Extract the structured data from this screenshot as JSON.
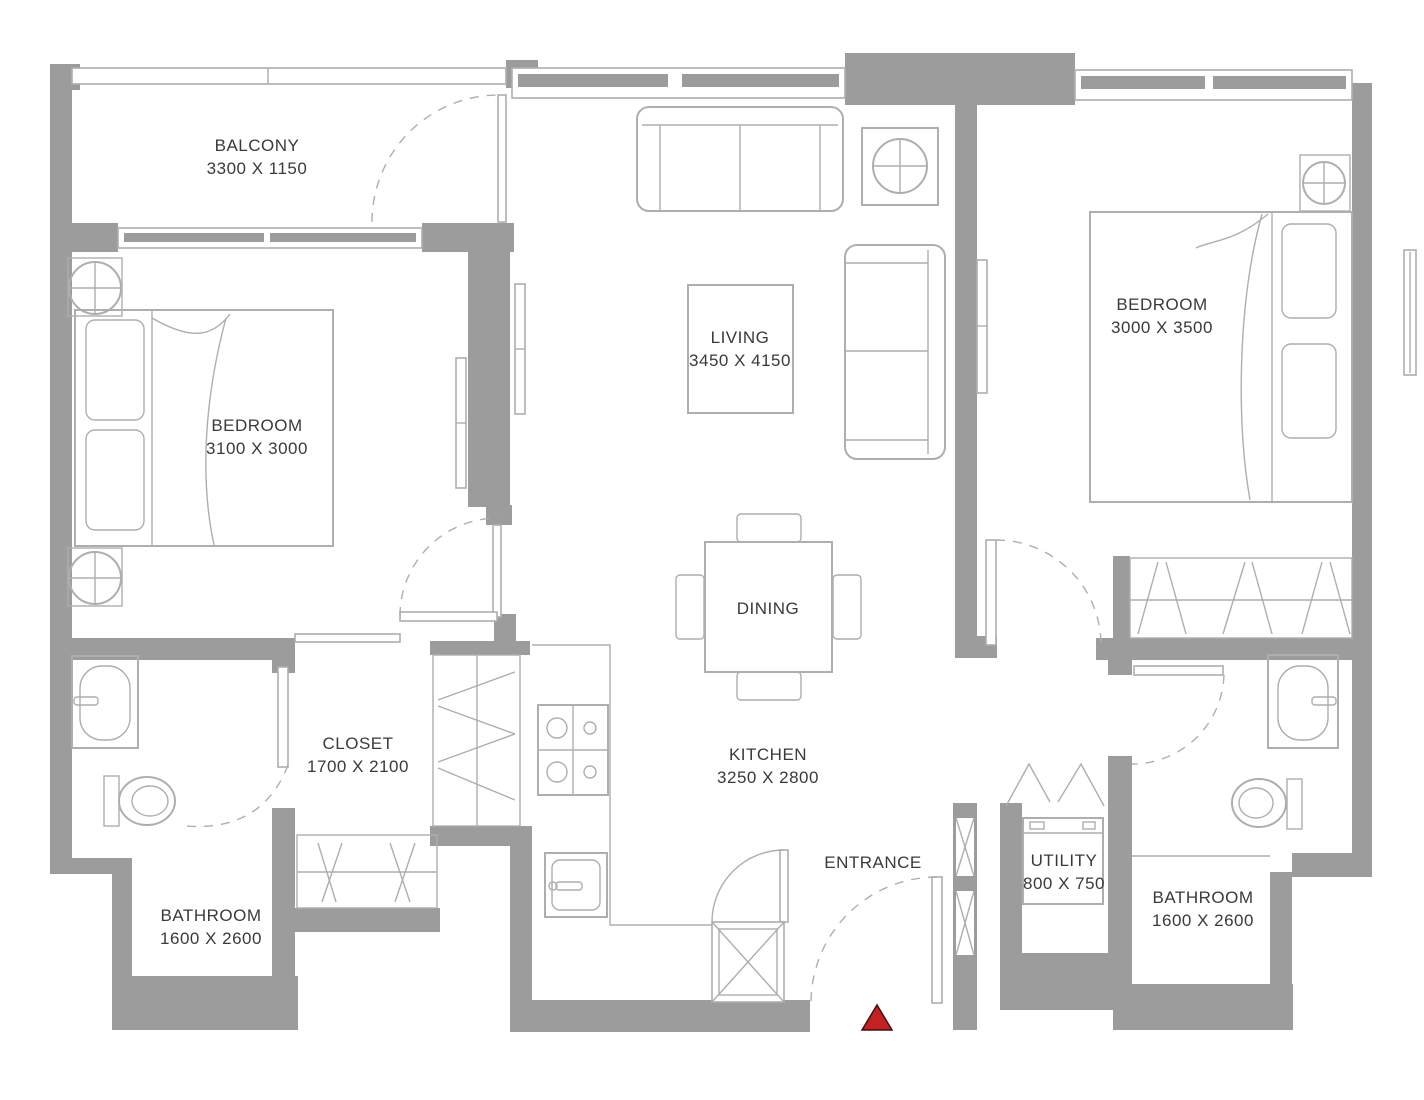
{
  "plan": {
    "rooms": {
      "balcony": {
        "name": "BALCONY",
        "dims": "3300 X 1150"
      },
      "bedroom_left": {
        "name": "BEDROOM",
        "dims": "3100 X 3000"
      },
      "bedroom_right": {
        "name": "BEDROOM",
        "dims": "3000 X 3500"
      },
      "living": {
        "name": "LIVING",
        "dims": "3450 X 4150"
      },
      "dining": {
        "name": "DINING"
      },
      "kitchen": {
        "name": "KITCHEN",
        "dims": "3250 X 2800"
      },
      "closet": {
        "name": "CLOSET",
        "dims": "1700 X 2100"
      },
      "bathroom_left": {
        "name": "BATHROOM",
        "dims": "1600 X 2600"
      },
      "bathroom_right": {
        "name": "BATHROOM",
        "dims": "1600 X 2600"
      },
      "utility": {
        "name": "UTILITY",
        "dims": "800 X 750"
      },
      "entrance": {
        "name": "ENTRANCE"
      }
    },
    "colors": {
      "wall": "#9c9c9c",
      "line": "#aeaeae",
      "text": "#3a3a3a",
      "marker": "#c32222",
      "background": "#ffffff"
    }
  }
}
